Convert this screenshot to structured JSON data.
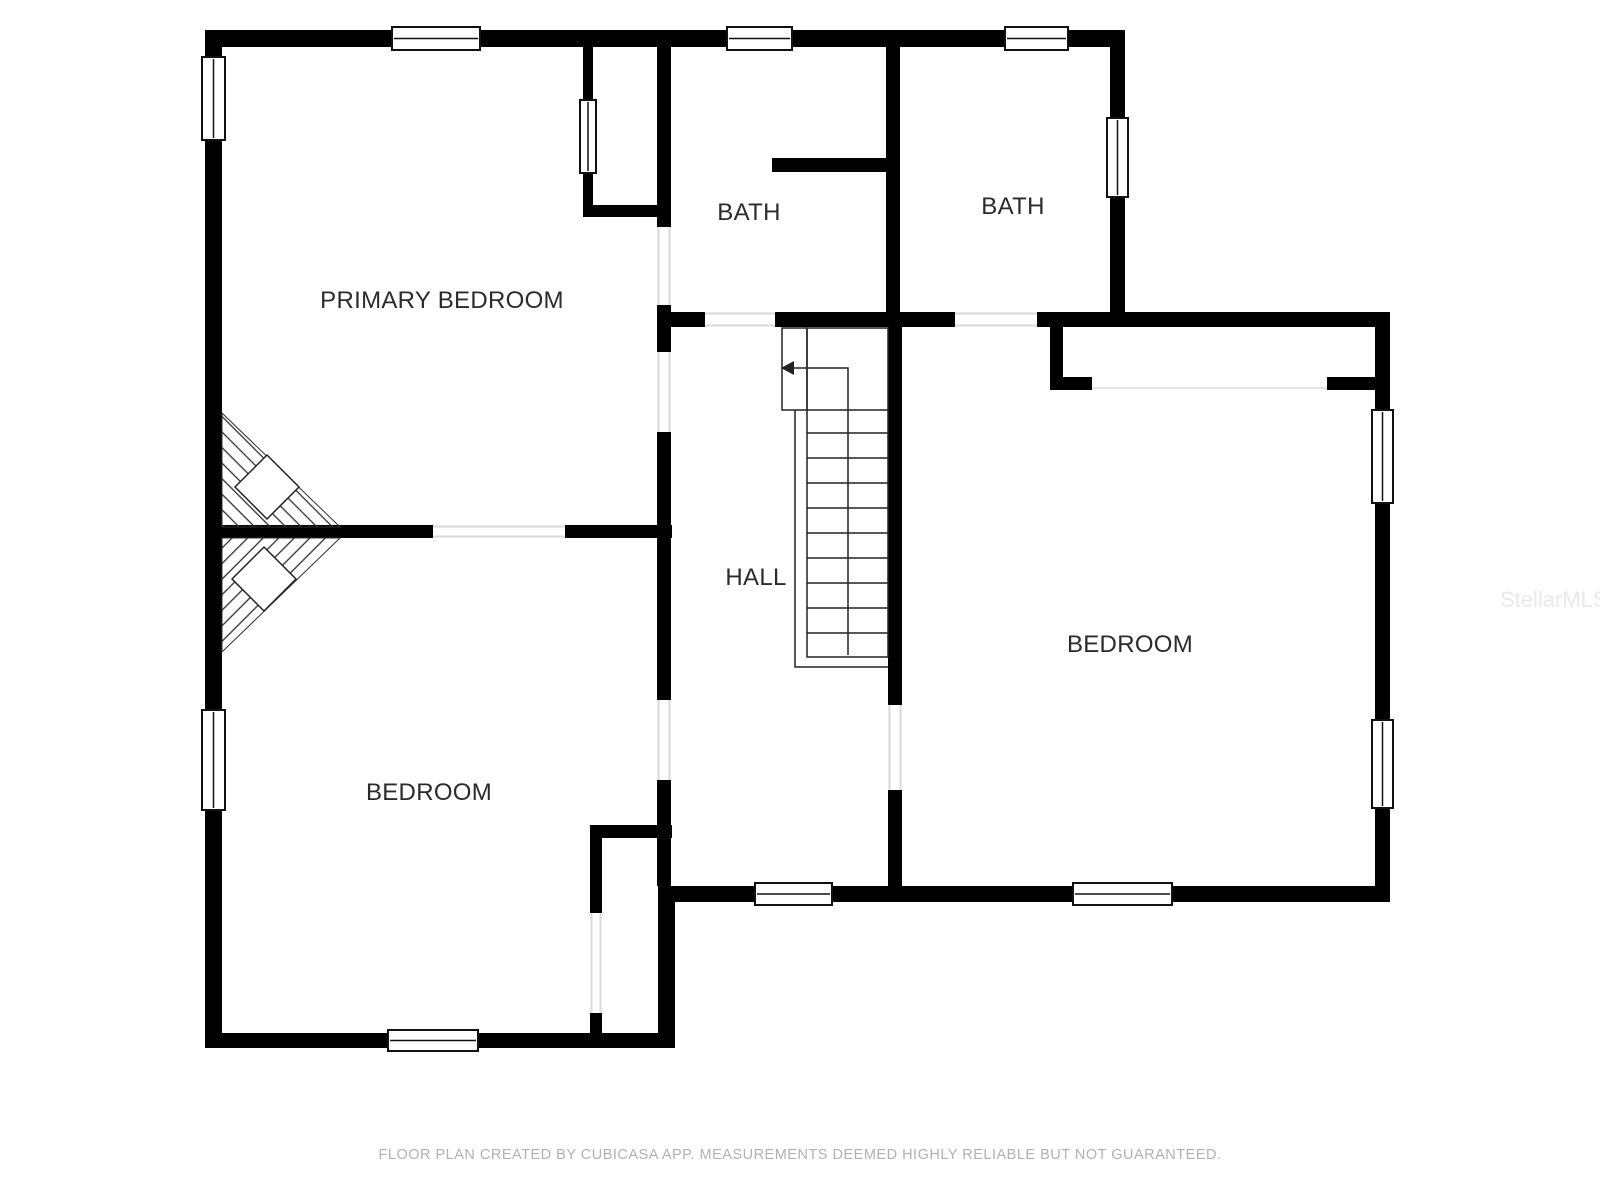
{
  "floor_plan": {
    "rooms": [
      {
        "name": "primary-bedroom",
        "label": "PRIMARY BEDROOM"
      },
      {
        "name": "bath-1",
        "label": "BATH"
      },
      {
        "name": "bath-2",
        "label": "BATH"
      },
      {
        "name": "hall",
        "label": "HALL"
      },
      {
        "name": "bedroom-right",
        "label": "BEDROOM"
      },
      {
        "name": "bedroom-bottom-left",
        "label": "BEDROOM"
      }
    ],
    "stair_direction_icon": "left-arrow"
  },
  "watermark": {
    "text": "StellarMLS"
  },
  "footer": {
    "disclaimer": "FLOOR PLAN CREATED BY CUBICASA APP. MEASUREMENTS DEEMED HIGHLY RELIABLE BUT NOT GUARANTEED."
  },
  "colors": {
    "background": "#ffffff",
    "wall": "#000000",
    "label_text": "#2b2b2b",
    "door_line": "#d9d9d9",
    "window_stroke": "#111111",
    "stair_line": "#222222",
    "hatch_line": "#2f2f2f",
    "footer_text": "#b1b1b1",
    "watermark_text": "#e9e9e9"
  }
}
